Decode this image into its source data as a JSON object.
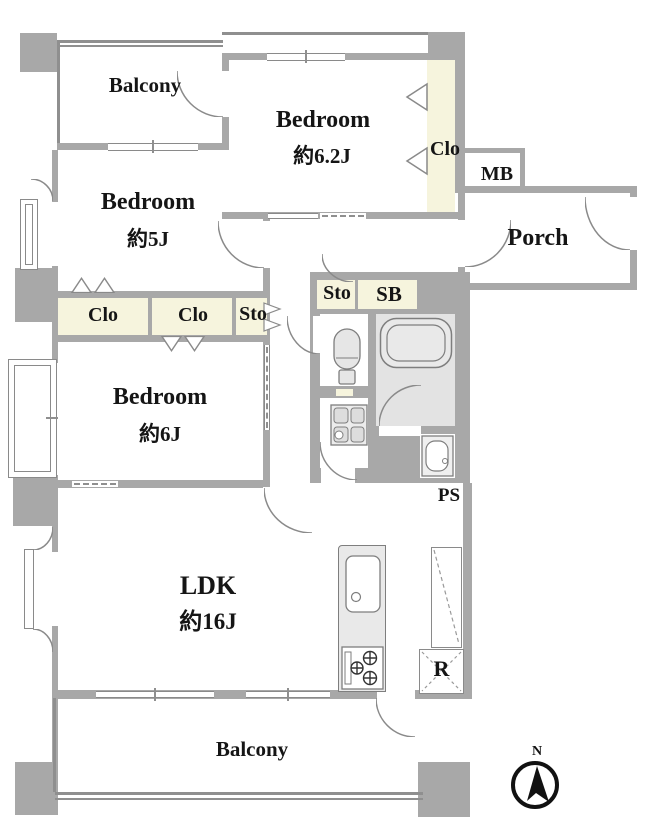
{
  "plan": {
    "rooms": {
      "balcony_top": "Balcony",
      "bedroom_62": {
        "name": "Bedroom",
        "size": "約6.2J"
      },
      "clo_main": "Clo",
      "mb": "MB",
      "porch": "Porch",
      "bedroom_5": {
        "name": "Bedroom",
        "size": "約5J"
      },
      "clo_a": "Clo",
      "clo_b": "Clo",
      "sto_1": "Sto",
      "sto_2": "Sto",
      "sb": "SB",
      "bedroom_6": {
        "name": "Bedroom",
        "size": "約6J"
      },
      "ps": "PS",
      "ldk": {
        "name": "LDK",
        "size": "約16J"
      },
      "refrigerator": "R",
      "balcony_bottom": "Balcony"
    },
    "compass": {
      "north": "N"
    },
    "colors": {
      "wall": "#a8a8a8",
      "closet_fill": "#f6f4dd",
      "bath_floor": "#e3e3e3",
      "fixture_line": "#7e7e7e",
      "text": "#151515"
    }
  }
}
